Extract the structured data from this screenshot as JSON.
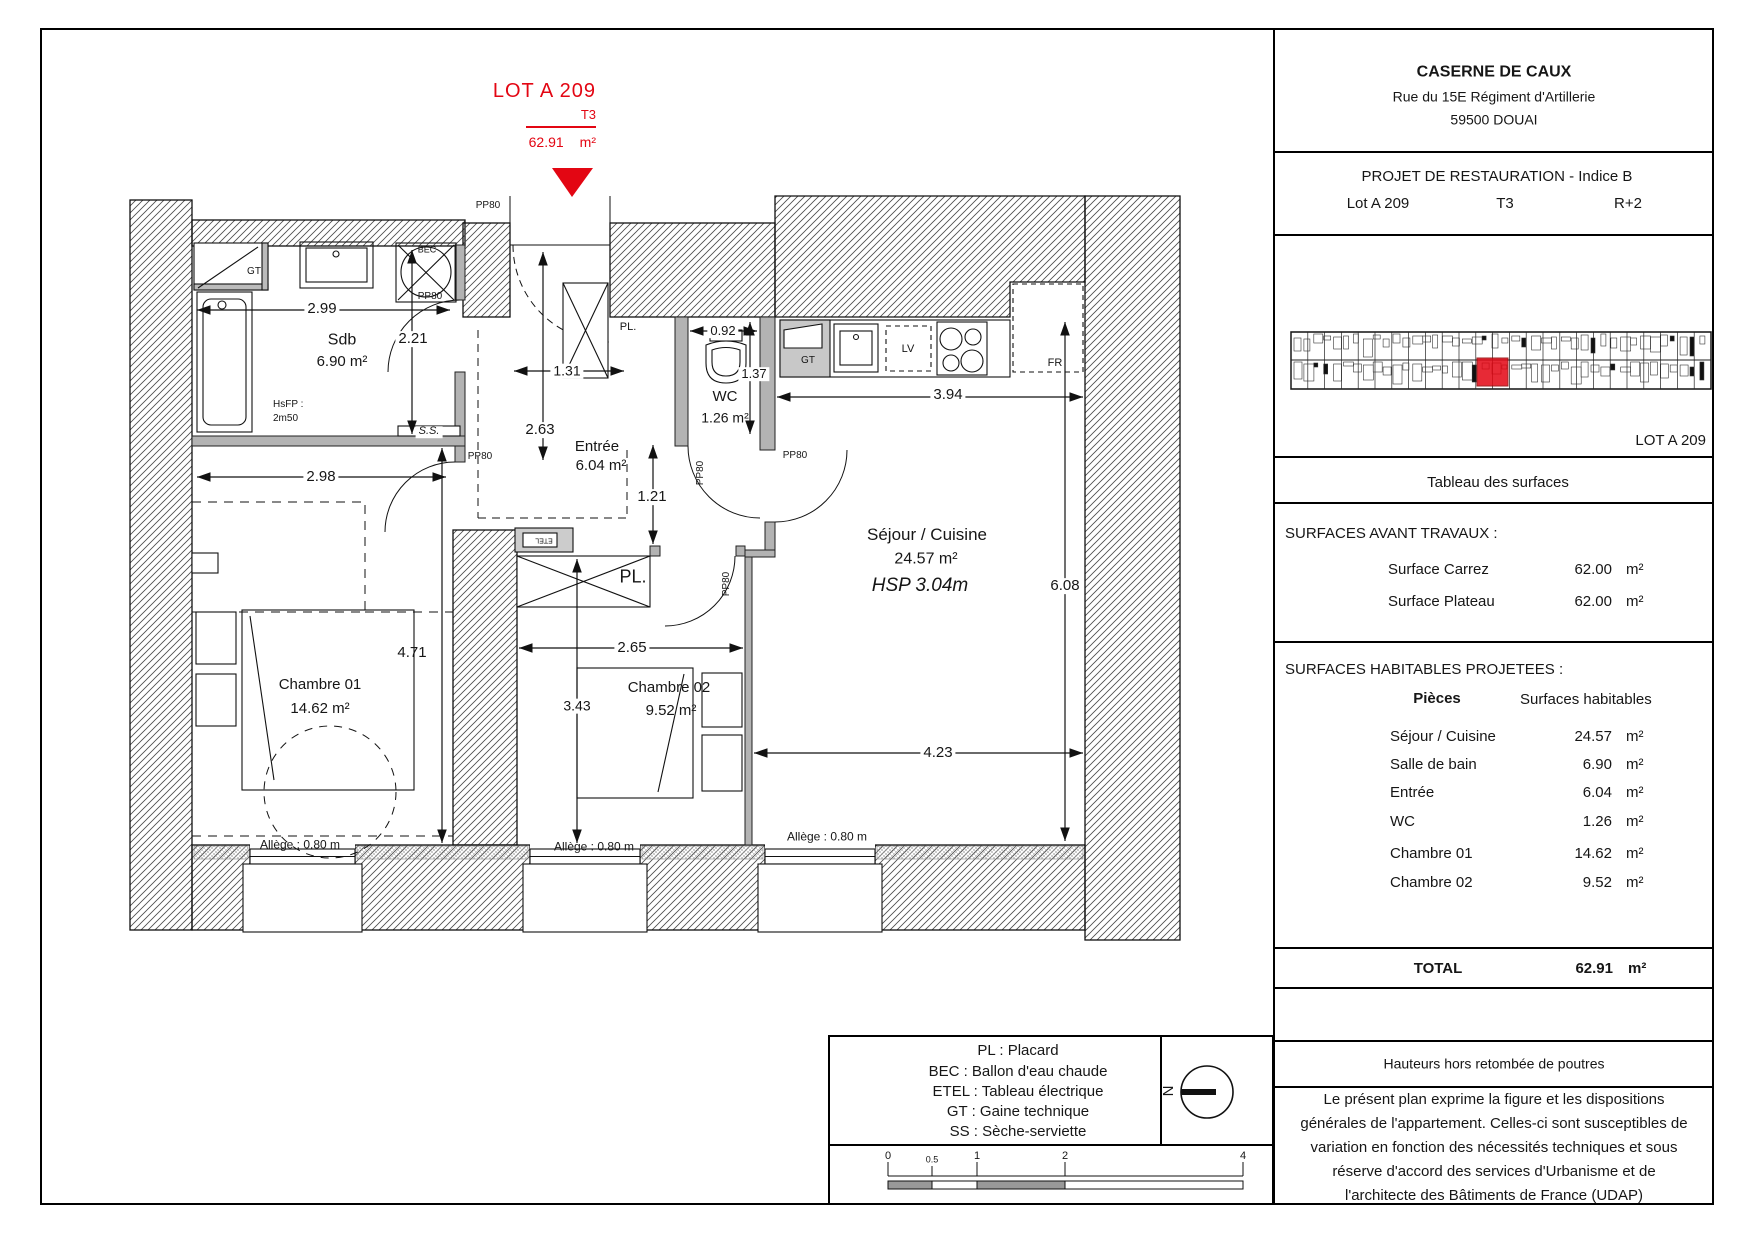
{
  "marker": {
    "lot": "LOT A 209",
    "type": "T3",
    "area": "62.91",
    "unit": "m²"
  },
  "colors": {
    "red": "#e30613"
  },
  "plan": {
    "rooms": {
      "sdb": {
        "name": "Sdb",
        "area": "6.90 m²"
      },
      "entree": {
        "name": "Entrée",
        "area": "6.04 m²"
      },
      "wc": {
        "name": "WC",
        "area": "1.26 m²"
      },
      "sejour": {
        "name": "Séjour / Cuisine",
        "area": "24.57 m²",
        "hsp": "HSP 3.04m"
      },
      "ch1": {
        "name": "Chambre 01",
        "area": "14.62 m²"
      },
      "ch2": {
        "name": "Chambre 02",
        "area": "9.52 m²"
      }
    },
    "dims": {
      "d299": "2.99",
      "d221": "2.21",
      "d298": "2.98",
      "d471": "4.71",
      "d131": "1.31",
      "d263": "2.63",
      "d121": "1.21",
      "d092": "0.92",
      "d137": "1.37",
      "d394": "3.94",
      "d608": "6.08",
      "d423": "4.23",
      "d265": "2.65",
      "d343": "3.43"
    },
    "tags": {
      "pp80": "PP80",
      "pl": "PL.",
      "gt": "GT",
      "bec": "BEC",
      "lv": "LV",
      "fr": "FR",
      "ss": "S.S.",
      "etel": "ETEL",
      "hsfp_l1": "HsFP :",
      "hsfp_l2": "2m50"
    },
    "allege": "Allège : 0.80 m"
  },
  "titleblock": {
    "name": "CASERNE DE CAUX",
    "address1": "Rue du 15E Régiment d'Artillerie",
    "address2": "59500 DOUAI",
    "project": "PROJET DE RESTAURATION - Indice B",
    "lot": "Lot A 209",
    "type": "T3",
    "floor": "R+2",
    "keyplan_lot": "LOT A 209",
    "table_title": "Tableau des surfaces",
    "before_title": "SURFACES AVANT TRAVAUX :",
    "before_rows": [
      {
        "label": "Surface Carrez",
        "value": "62.00",
        "unit": "m²"
      },
      {
        "label": "Surface Plateau",
        "value": "62.00",
        "unit": "m²"
      }
    ],
    "proj_title": "SURFACES HABITABLES PROJETEES :",
    "col_rooms": "Pièces",
    "col_surfaces": "Surfaces habitables",
    "rows": [
      {
        "label": "Séjour / Cuisine",
        "value": "24.57",
        "unit": "m²"
      },
      {
        "label": "Salle de bain",
        "value": "6.90",
        "unit": "m²"
      },
      {
        "label": "Entrée",
        "value": "6.04",
        "unit": "m²"
      },
      {
        "label": "WC",
        "value": "1.26",
        "unit": "m²"
      },
      {
        "label": "Chambre 01",
        "value": "14.62",
        "unit": "m²"
      },
      {
        "label": "Chambre 02",
        "value": "9.52",
        "unit": "m²"
      }
    ],
    "total_label": "TOTAL",
    "total_value": "62.91",
    "total_unit": "m²",
    "heights_note": "Hauteurs hors retombée de poutres",
    "disclaimer": [
      "Le présent plan exprime la figure et les dispositions",
      "générales de l'appartement. Celles-ci sont susceptibles de",
      "variation en fonction des nécessités techniques et sous",
      "réserve d'accord des services d'Urbanisme et de",
      "l'architecte des Bâtiments de France (UDAP)"
    ]
  },
  "legend": {
    "lines": [
      "PL : Placard",
      "BEC : Ballon d'eau chaude",
      "ETEL : Tableau électrique",
      "GT : Gaine technique",
      "SS : Sèche-serviette"
    ]
  },
  "north": "N",
  "scalebar": {
    "t0": "0",
    "t05": "0.5",
    "t1": "1",
    "t2": "2",
    "t4": "4"
  }
}
